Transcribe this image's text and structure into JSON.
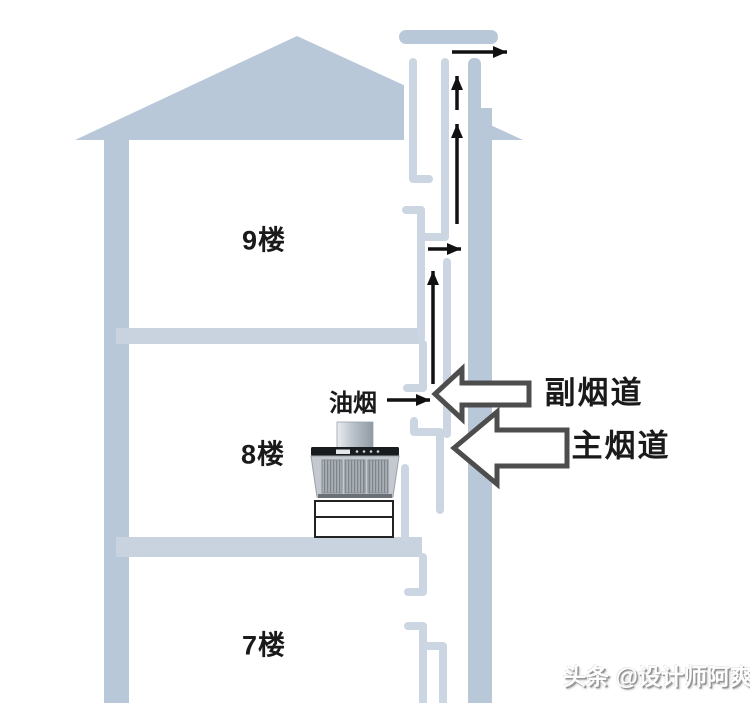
{
  "diagram": {
    "floor_labels": [
      "9楼",
      "8楼",
      "7楼"
    ],
    "fume_label": "油烟",
    "flue_arrows": {
      "secondary": "副烟道",
      "main": "主烟道"
    },
    "watermark": "头条 @设计师阿爽",
    "colors": {
      "building": "#b9c8d9",
      "duct_wall": "#ccd6e2",
      "slab": "#c9d3e0",
      "airflow_arrow": "#111111",
      "label_arrow_fill": "#ffffff",
      "label_arrow_border": "#4d4d4d",
      "label_text": "#1a1a1a",
      "watermark_gray": "#979797"
    }
  }
}
